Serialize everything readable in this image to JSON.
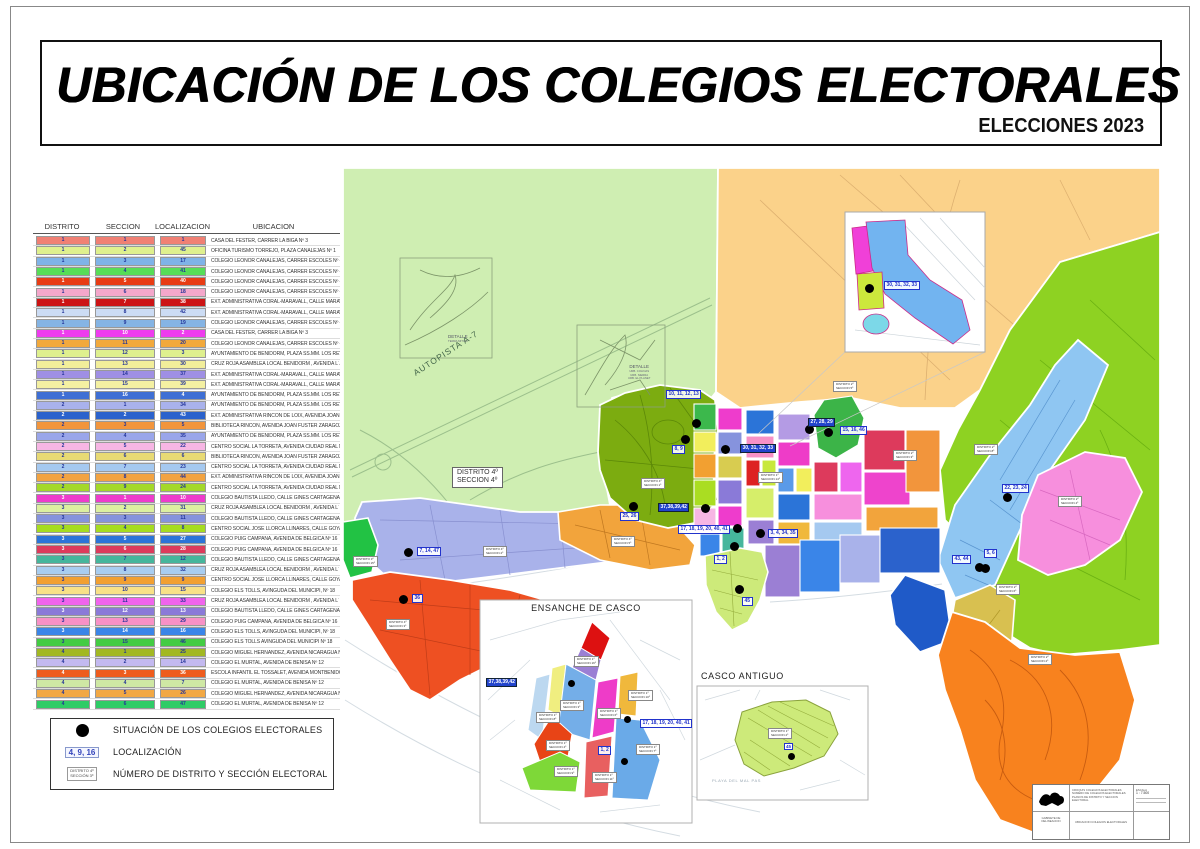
{
  "page": {
    "title": "UBICACIÓN  DE LOS COLEGIOS  ELECTORALES",
    "subtitle": "ELECCIONES 2023"
  },
  "table": {
    "headers": [
      "DISTRITO",
      "SECCION",
      "LOCALIZACION",
      "UBICACION"
    ],
    "rows": [
      {
        "d": "1",
        "s": "1",
        "l": "1",
        "u": "CASA  DEL  FESTER,   CARRER LA BIGA Nº 3",
        "c": "#f08074"
      },
      {
        "d": "1",
        "s": "2",
        "l": "45",
        "u": "OFICINA TURISMO TORREJO,  PLAZA CANALEJAS  Nº 1",
        "c": "#dff08e"
      },
      {
        "d": "1",
        "s": "3",
        "l": "17",
        "u": "COLEGIO LEONOR CANALEJAS,  CARRER   ESCOLES  Nº 4",
        "c": "#7fb3e8"
      },
      {
        "d": "1",
        "s": "4",
        "l": "41",
        "u": "COLEGIO LEONOR CANALEJAS,  CARRER   ESCOLES  Nº 4",
        "c": "#57dd57"
      },
      {
        "d": "1",
        "s": "5",
        "l": "40",
        "u": "COLEGIO LEONOR CANALEJAS,  CARRER   ESCOLES  Nº 4",
        "c": "#e83c14"
      },
      {
        "d": "1",
        "s": "6",
        "l": "18",
        "u": "COLEGIO LEONOR CANALEJAS,  CARRER   ESCOLES  Nº 4",
        "c": "#f4a7cb"
      },
      {
        "d": "1",
        "s": "7",
        "l": "38",
        "u": "EXT. ADMINISTRATIVA CORAL-MARAVALL, CALLE MARAVALL Nº 33",
        "c": "#cc1414"
      },
      {
        "d": "1",
        "s": "8",
        "l": "42",
        "u": "EXT. ADMINISTRATIVA CORAL-MARAVALL, CALLE MARAVALL Nº 33",
        "c": "#ccdcf4"
      },
      {
        "d": "1",
        "s": "9",
        "l": "19",
        "u": "COLEGIO LEONOR CANALEJAS,  CARRER   ESCOLES   Nº 4",
        "c": "#85b4e4"
      },
      {
        "d": "1",
        "s": "10",
        "l": "2",
        "u": "CASA  DEL  FESTER,   CARRER LA BIGA Nº 3",
        "c": "#ee3cee"
      },
      {
        "d": "1",
        "s": "11",
        "l": "20",
        "u": "COLEGIO LEONOR CANALEJAS,  CARRER   ESCOLES   Nº 4",
        "c": "#f2a93c"
      },
      {
        "d": "1",
        "s": "12",
        "l": "3",
        "u": "AYUNTAMIENTO DE BENIDORM, PLAZA SS.MM. LOS REYES DE ESPAÑA Nº 1",
        "c": "#dff08e"
      },
      {
        "d": "1",
        "s": "13",
        "l": "30",
        "u": "CRUZ ROJA ASAMBLEA LOCAL BENIDORM ,  AVENIDA  L´AIGÜERA   Nº15",
        "c": "#f2ee9a"
      },
      {
        "d": "1",
        "s": "14",
        "l": "37",
        "u": "EXT. ADMINISTRATIVA CORAL-MARAVALL, CALLE MARAVALL Nº 33",
        "c": "#9f8fe4"
      },
      {
        "d": "1",
        "s": "15",
        "l": "39",
        "u": "EXT. ADMINISTRATIVA CORAL-MARAVALL, CALLE MARAVALL Nº 33",
        "c": "#f4f0a2"
      },
      {
        "d": "1",
        "s": "16",
        "l": "4",
        "u": "AYUNTAMIENTO DE BENIDORM, PLAZA SS.MM. LOS REYES DE ESPAÑA Nº 1",
        "c": "#3f6fd4"
      },
      {
        "d": "2",
        "s": "1",
        "l": "34",
        "u": "AYUNTAMIENTO DE BENIDORM, PLAZA SS.MM. LOS REYES DE ESPAÑA Nº 1",
        "c": "#a9b2ec"
      },
      {
        "d": "2",
        "s": "2",
        "l": "43",
        "u": "EXT. ADMINISTRATIVA RINCÓN DE LOIX, AVENIDA JOAN FUSTER ZARAGOZA  Nº 1",
        "c": "#2b62cc"
      },
      {
        "d": "2",
        "s": "3",
        "l": "5",
        "u": "BIBLIOTECA RINCON,  AVENIDA  JOAN FUSTER ZARAGOZA Nº 1",
        "c": "#f2953c"
      },
      {
        "d": "2",
        "s": "4",
        "l": "35",
        "u": "AYUNTAMIENTO DE BENIDORM, PLAZA SS.MM. LOS REYES DE ESPAÑA Nº 1",
        "c": "#9aa6ea"
      },
      {
        "d": "2",
        "s": "5",
        "l": "22",
        "u": "CENTRO SOCIAL LA TORRETA, AVENIDA CIUDAD REAL Nº6",
        "c": "#f7b6e4"
      },
      {
        "d": "2",
        "s": "6",
        "l": "6",
        "u": "BIBLIOTECA RINCON, AVENIDA JOAN FUSTER ZARAGOZA  Nº 1",
        "c": "#e8da74"
      },
      {
        "d": "2",
        "s": "7",
        "l": "23",
        "u": "CENTRO SOCIAL LA TORRETA, AVENIDA CIUDAD REAL Nº6",
        "c": "#a5c9f0"
      },
      {
        "d": "2",
        "s": "8",
        "l": "44",
        "u": "EXT. ADMINISTRATIVA RINCÓN DE LOIX, AVENIDA JOAN FUSTER ZARAGOZA  Nº 1",
        "c": "#f2a341"
      },
      {
        "d": "2",
        "s": "9",
        "l": "24",
        "u": "CENTRO SOCIAL LA TORRETA, AVENIDA CIUDAD REAL Nº6",
        "c": "#a4d82a"
      },
      {
        "d": "3",
        "s": "1",
        "l": "10",
        "u": "COLEGIO BAUTISTA LLEDO,  CALLE GINES CARTAGENA Nº 5",
        "c": "#ee3ccc"
      },
      {
        "d": "3",
        "s": "2",
        "l": "31",
        "u": "CRUZ ROJA ASAMBLEA LOCAL BENIDORM ,  AVENIDA  L´ AIGÜERA   Nº15",
        "c": "#dcf0a0"
      },
      {
        "d": "3",
        "s": "3",
        "l": "11",
        "u": "COLEGIO BAUTISTA LLEDO,  CALLE GINES CARTAGENA Nº 5",
        "c": "#8693dd"
      },
      {
        "d": "3",
        "s": "4",
        "l": "8",
        "u": "CENTRO SOCIAL JOSÉ LLORCA LLINARES,  CALLE GOYA Nº14",
        "c": "#a6dc20"
      },
      {
        "d": "3",
        "s": "5",
        "l": "27",
        "u": "COLEGIO PUIG CAMPANA,  AVENIDA DE BELGICA  Nº 16",
        "c": "#2b74d8"
      },
      {
        "d": "3",
        "s": "6",
        "l": "28",
        "u": "COLEGIO PUIG CAMPANA,  AVENIDA DE BELGICA  Nº 16",
        "c": "#dd3a5c"
      },
      {
        "d": "3",
        "s": "7",
        "l": "12",
        "u": "COLEGIO BAUTISTA LLEDO,  CALLE GINES CARTAGENA Nº 5",
        "c": "#46b69c"
      },
      {
        "d": "3",
        "s": "8",
        "l": "32",
        "u": "CRUZ ROJA ASAMBLEA LOCAL BENIDORM ,  AVENIDA  L´ AIGÜERA   Nº15",
        "c": "#a8cdf0"
      },
      {
        "d": "3",
        "s": "9",
        "l": "9",
        "u": "CENTRO SOCIAL JOSÉ LLORCA LLINARES,  CALLE GOYA Nº14 .",
        "c": "#f2a031"
      },
      {
        "d": "3",
        "s": "10",
        "l": "15",
        "u": "COLEGIO  ELS  TOLLS,  AVINGUDA DEL MUNICIPI,  Nº 18",
        "c": "#f8e187"
      },
      {
        "d": "3",
        "s": "11",
        "l": "33",
        "u": "CRUZ ROJA ASAMBLEA LOCAL BENIDORM ,  AVENIDA  L´ AIGÜERA   Nº15",
        "c": "#f064ec"
      },
      {
        "d": "3",
        "s": "12",
        "l": "13",
        "u": "COLEGIO BAUTISTA LLEDO,  CALLE GINES CARTAGENA Nº 5",
        "c": "#8a7ad8"
      },
      {
        "d": "3",
        "s": "13",
        "l": "29",
        "u": "COLEGIO PUIG CAMPANA,  AVENIDA DE BELGICA  Nº 16",
        "c": "#f791c6"
      },
      {
        "d": "3",
        "s": "14",
        "l": "16",
        "u": "COLEGIO  ELS  TOLLS,  AVINGUDA DEL MUNICIPI,  Nº 18",
        "c": "#3a85e8"
      },
      {
        "d": "3",
        "s": "15",
        "l": "46",
        "u": "COLEGIO ELS TOLLS  AVINGUDA DEL MUNICIPI Nº 18",
        "c": "#43cc43"
      },
      {
        "d": "4",
        "s": "1",
        "l": "25",
        "u": "COLEGIO MIGUEL HERNANDEZ,  AVENIDA  NICARAGUA  Nº 17",
        "c": "#a2b822"
      },
      {
        "d": "4",
        "s": "2",
        "l": "14",
        "u": "COLEGIO  EL  MURTAL,  AVENIDA DE BENISA  Nº 12",
        "c": "#c3b9f0"
      },
      {
        "d": "4",
        "s": "3",
        "l": "36",
        "u": "ESCOLA INFANTIL EL TOSSALET,  AVENIDA MONTBENIDORM Nº7",
        "c": "#ee5c1e"
      },
      {
        "d": "4",
        "s": "4",
        "l": "7",
        "u": "COLEGIO  EL  MURTAL,  AVENIDA DE BENISA  Nº 12",
        "c": "#cfe8a4"
      },
      {
        "d": "4",
        "s": "5",
        "l": "26",
        "u": "COLEGIO MIGUEL HERNANDEZ,  AVENIDA  NICARAGUA  Nº 17",
        "c": "#f2a843"
      },
      {
        "d": "4",
        "s": "6",
        "l": "47",
        "u": "COLEGIO  EL  MURTAL,  AVENIDA DE BENISA  Nº 12",
        "c": "#2ecc66"
      }
    ]
  },
  "legend": {
    "items": [
      {
        "label": "SITUACIÓN DE LOS COLEGIOS ELECTORALES"
      },
      {
        "chip": "4, 9, 16",
        "label": "LOCALIZACIÓN"
      },
      {
        "box_line1": "DISTRITO  4º",
        "box_line2": "SECCIÓN  3º",
        "label": "NÚMERO DE DISTRITO Y SECCIÓN ELECTORAL"
      }
    ]
  },
  "map": {
    "road_label": "AUTOPISTA  A-7",
    "detail1": {
      "line1": "DETALLE",
      "line2": "TERRA  MITICA"
    },
    "detail2": {
      "title": "DETALLE",
      "lines": [
        "URB. COLINAS",
        "URB. SIERRA",
        "URB. EL PLANET"
      ]
    },
    "number_labels": [
      {
        "text": "30, 31, 32, 33",
        "x": 884,
        "y": 281,
        "inv": false
      },
      {
        "text": "10, 11, 12, 13",
        "x": 666,
        "y": 390,
        "inv": false
      },
      {
        "text": "8, 9",
        "x": 672,
        "y": 445,
        "inv": false
      },
      {
        "text": "30, 31, 32, 33",
        "x": 740,
        "y": 444,
        "inv": true
      },
      {
        "text": "27, 28, 29",
        "x": 808,
        "y": 418,
        "inv": true
      },
      {
        "text": "15, 16, 46",
        "x": 840,
        "y": 426,
        "inv": false
      },
      {
        "text": "37,38,39,42",
        "x": 658,
        "y": 503,
        "inv": true
      },
      {
        "text": "17, 18, 19, 20, 40, 41",
        "x": 678,
        "y": 525,
        "inv": false
      },
      {
        "text": "3, 4, 34, 35",
        "x": 768,
        "y": 529,
        "inv": false
      },
      {
        "text": "1, 2",
        "x": 714,
        "y": 555,
        "inv": false
      },
      {
        "text": "45",
        "x": 742,
        "y": 597,
        "inv": false
      },
      {
        "text": "22, 23, 24",
        "x": 1002,
        "y": 484,
        "inv": false
      },
      {
        "text": "43, 44",
        "x": 952,
        "y": 555,
        "inv": false
      },
      {
        "text": "5, 6",
        "x": 984,
        "y": 549,
        "inv": false
      },
      {
        "text": "7, 14, 47",
        "x": 417,
        "y": 547,
        "inv": false
      },
      {
        "text": "36",
        "x": 412,
        "y": 594,
        "inv": false
      },
      {
        "text": "25, 26",
        "x": 620,
        "y": 512,
        "inv": false
      }
    ],
    "dots": [
      {
        "x": 696,
        "y": 423
      },
      {
        "x": 685,
        "y": 439
      },
      {
        "x": 725,
        "y": 449
      },
      {
        "x": 809,
        "y": 429
      },
      {
        "x": 828,
        "y": 432
      },
      {
        "x": 705,
        "y": 508
      },
      {
        "x": 737,
        "y": 528
      },
      {
        "x": 760,
        "y": 533
      },
      {
        "x": 734,
        "y": 546
      },
      {
        "x": 739,
        "y": 589
      },
      {
        "x": 1007,
        "y": 497
      },
      {
        "x": 979,
        "y": 567
      },
      {
        "x": 985,
        "y": 568
      },
      {
        "x": 408,
        "y": 552
      },
      {
        "x": 403,
        "y": 599
      },
      {
        "x": 633,
        "y": 506
      },
      {
        "x": 869,
        "y": 288
      }
    ],
    "district_boxes": [
      {
        "l1": "DISTRITO   4º",
        "l2": "SECCION   4º",
        "x": 452,
        "y": 467,
        "big": true
      },
      {
        "l1": "DISTRITO  4º",
        "l2": "SECCION  1º",
        "x": 641,
        "y": 478,
        "big": false
      },
      {
        "l1": "DISTRITO  4º",
        "l2": "SECCION  5º",
        "x": 611,
        "y": 536,
        "big": false
      },
      {
        "l1": "DISTRITO  4º",
        "l2": "SECCION  2º",
        "x": 483,
        "y": 546,
        "big": false
      },
      {
        "l1": "DISTRITO  3º",
        "l2": "SECCION  15º",
        "x": 353,
        "y": 556,
        "big": false
      },
      {
        "l1": "DISTRITO  4º",
        "l2": "SECCION  3º",
        "x": 386,
        "y": 619,
        "big": false
      },
      {
        "l1": "DISTRITO  2º",
        "l2": "SECCION  5º",
        "x": 833,
        "y": 381,
        "big": false
      },
      {
        "l1": "DISTRITO  2º",
        "l2": "SECCION  8º",
        "x": 974,
        "y": 444,
        "big": false
      },
      {
        "l1": "DISTRITO  2º",
        "l2": "SECCION  3º",
        "x": 893,
        "y": 450,
        "big": false
      },
      {
        "l1": "DISTRITO  2º",
        "l2": "SECCION  4º",
        "x": 1058,
        "y": 496,
        "big": false
      },
      {
        "l1": "DISTRITO  2º",
        "l2": "SECCION  6º",
        "x": 996,
        "y": 584,
        "big": false
      },
      {
        "l1": "DISTRITO  2º",
        "l2": "SECCION  2º",
        "x": 1028,
        "y": 654,
        "big": false
      },
      {
        "l1": "DISTRITO  1º",
        "l2": "SECCION  14º",
        "x": 758,
        "y": 472,
        "big": false
      }
    ]
  },
  "insets": {
    "ensanche": {
      "title": "ENSANCHE DE CASCO",
      "number_labels": [
        {
          "text": "37,38,39,42",
          "x": 486,
          "y": 678,
          "inv": true
        },
        {
          "text": "17, 18, 19, 20, 40, 41",
          "x": 640,
          "y": 719,
          "inv": false
        },
        {
          "text": "1, 2",
          "x": 598,
          "y": 746,
          "inv": false
        }
      ],
      "dots": [
        {
          "x": 572,
          "y": 684
        },
        {
          "x": 628,
          "y": 720
        },
        {
          "x": 625,
          "y": 762
        }
      ],
      "district_boxes": [
        {
          "l1": "DISTRITO 1º",
          "l2": "SECCION 16º",
          "x": 574,
          "y": 656
        },
        {
          "l1": "DISTRITO 1º",
          "l2": "SECCION 3º",
          "x": 560,
          "y": 700
        },
        {
          "l1": "DISTRITO 1º",
          "l2": "SECCION 6º",
          "x": 597,
          "y": 708
        },
        {
          "l1": "DISTRITO 1º",
          "l2": "SECCION 8º",
          "x": 536,
          "y": 712
        },
        {
          "l1": "DISTRITO 1º",
          "l2": "SECCION 4º",
          "x": 546,
          "y": 740
        },
        {
          "l1": "DISTRITO 1º",
          "l2": "SECCION 9º",
          "x": 554,
          "y": 766
        },
        {
          "l1": "DISTRITO 1º",
          "l2": "SECCION 11º",
          "x": 592,
          "y": 772
        },
        {
          "l1": "DISTRITO 1º",
          "l2": "SECCION 7º",
          "x": 636,
          "y": 744
        },
        {
          "l1": "DISTRITO 1º",
          "l2": "SECCION 10º",
          "x": 628,
          "y": 690
        }
      ]
    },
    "casco": {
      "title": "CASCO ANTIGUO",
      "chip": "45",
      "box_line1": "DISTRITO 1º",
      "box_line2": "SECCION 2º",
      "beach_text": "PLAYA  DEL  MAL  PAS"
    }
  },
  "cartouche": {
    "rows_top": [
      "CROQUIS COLEGIOS ELECTORALES",
      "NUMERO DE COLEGIOS ELECTORALES",
      "PLANOS DE DISTRITO Y SECCION ELECTORAL"
    ],
    "scale_label": "ESCALA",
    "scale_value": "1 : 7.500",
    "left_bottom": "GABINETE DE DELINEACION",
    "center_bottom": "UBICACION  COLEGIOS  ELECTORALES"
  }
}
